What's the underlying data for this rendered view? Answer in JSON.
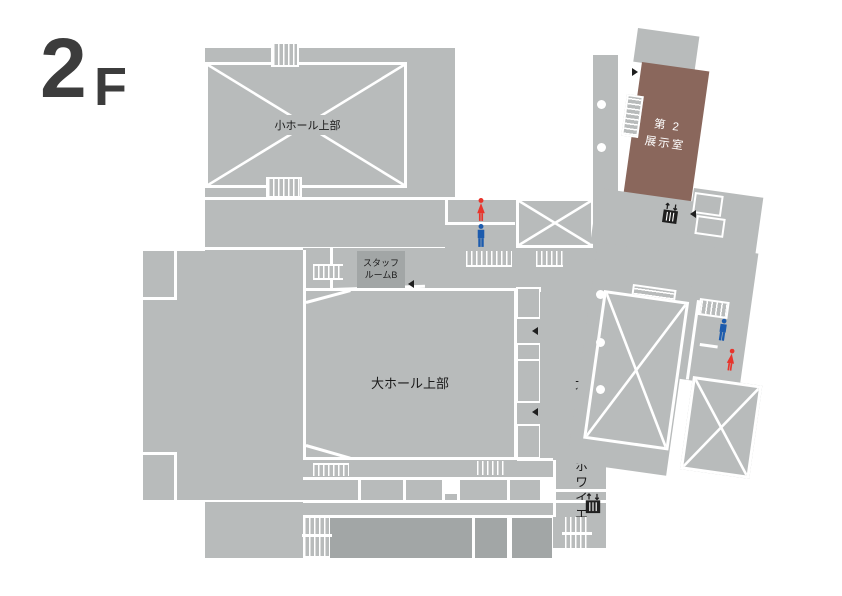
{
  "floor_label": {
    "number": "2",
    "suffix": "F"
  },
  "rooms": {
    "small_hall_upper": "小ホール上部",
    "exhibition_line1": "第 2",
    "exhibition_line2": "展示室",
    "staff_room_line1": "スタッフ",
    "staff_room_line2": "ルームB",
    "main_hall_upper": "大ホール上部",
    "main_hall_foyer": "大ホール ホワイエ",
    "main_hall_entrance": "大ホール入口"
  },
  "icons": {
    "restroom_female": "female-figure",
    "restroom_male": "male-figure",
    "elevator": "elevator-cabin-with-up-down-arrows",
    "stairs": "hatched-steps",
    "void_area": "white-crossed-rectangle",
    "direction_marker": "small-black-triangle",
    "column": "white-circle"
  },
  "colors": {
    "base": "#b8bbbb",
    "dark": "#a2a6a6",
    "brown": "#8a675c",
    "line": "#ffffff",
    "floor_text": "#3c3c3c",
    "female": "#e8342b",
    "male": "#1c5bad",
    "icon_dark": "#1f1f1f"
  }
}
